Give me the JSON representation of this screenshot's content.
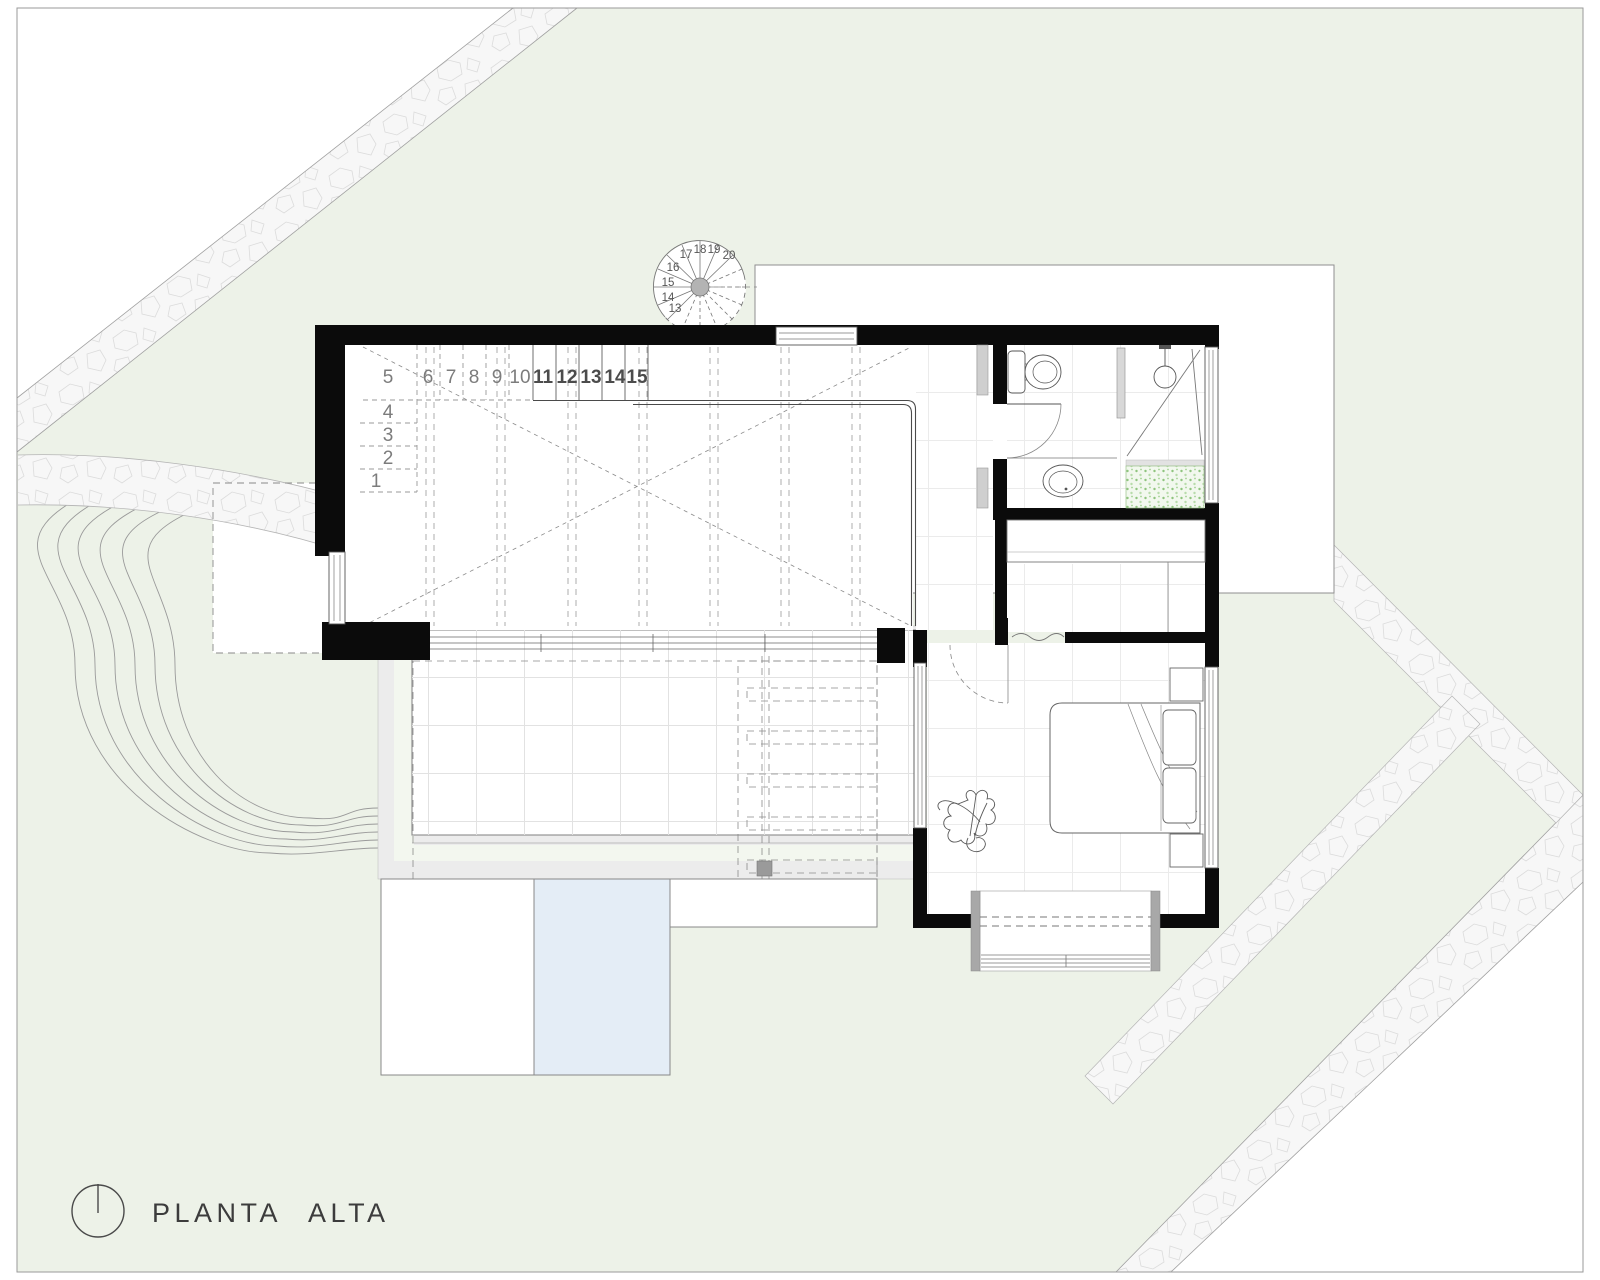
{
  "drawing": {
    "title": "PLANTA ALTA",
    "type": "upper floor architectural plan",
    "north_icon": "north-arrow"
  },
  "stairs": {
    "side_run": [
      "1",
      "2",
      "3",
      "4"
    ],
    "top_run": [
      "5",
      "6",
      "7",
      "8",
      "9",
      "10",
      "11",
      "12",
      "13",
      "14",
      "15"
    ],
    "spiral_run": [
      "13",
      "14",
      "15",
      "16",
      "17",
      "18",
      "19",
      "20"
    ]
  },
  "colors": {
    "site_green": "#edf2e8",
    "pale_green_strip": "#f3f7ef",
    "pool_blue": "#e4edf6",
    "planter_green": "#9cc98c",
    "wall_black": "#0b0b0b",
    "stone_fill": "#f7f7f7",
    "terrace_gray": "#ececec",
    "fixture_gray": "#cfcfcf"
  }
}
